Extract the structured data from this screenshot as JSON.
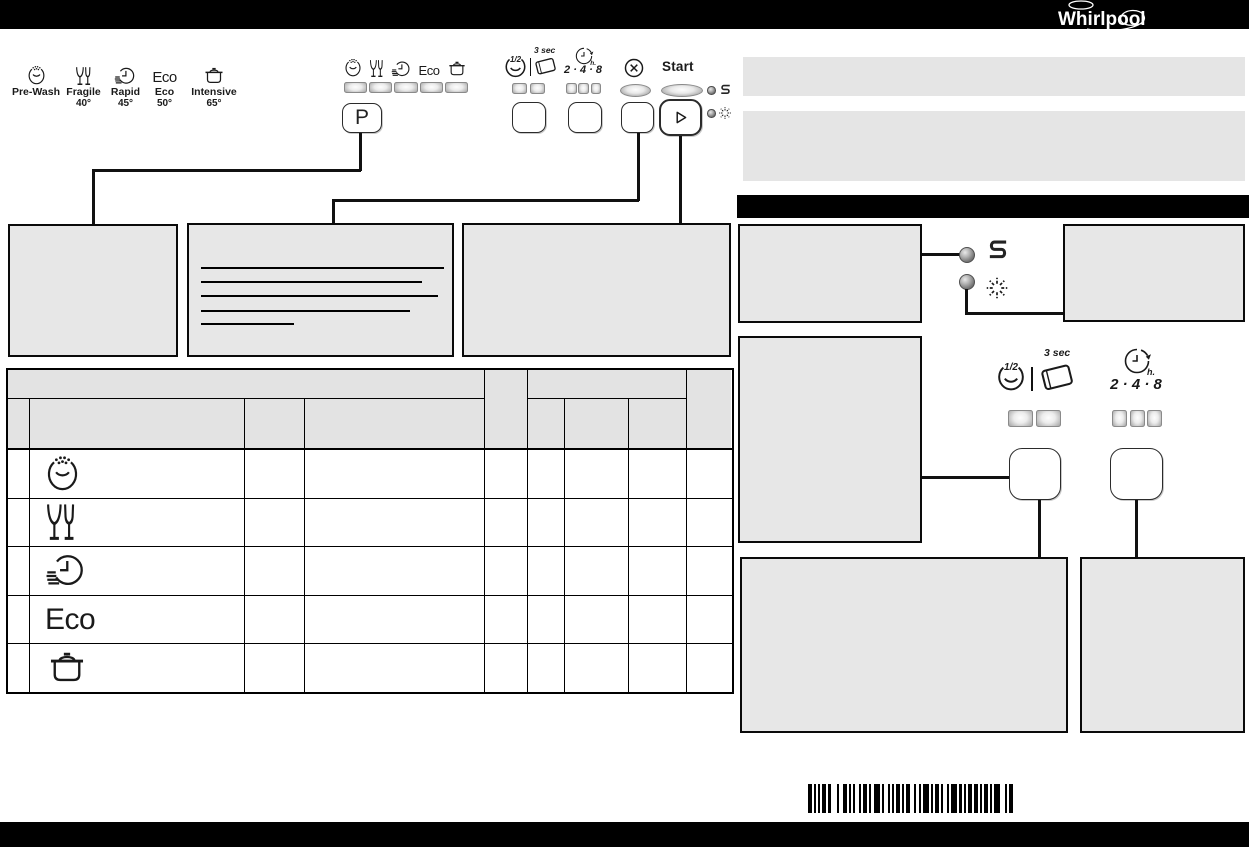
{
  "brand": {
    "logo_text": "Whirlpool"
  },
  "legend": {
    "programs": [
      {
        "name": "Pre-Wash",
        "temp": "",
        "icon": "prewash-icon"
      },
      {
        "name": "Fragile",
        "temp": "40°",
        "icon": "wine-glasses-icon"
      },
      {
        "name": "Rapid",
        "temp": "45°",
        "icon": "rapid-clock-icon"
      },
      {
        "name": "Eco",
        "temp": "50°",
        "icon": "eco-icon"
      },
      {
        "name": "Intensive",
        "temp": "65°",
        "icon": "pot-icon"
      }
    ]
  },
  "panel": {
    "program_button_label": "P",
    "eco_icon_text": "Eco",
    "half_load_label": "1/2",
    "tablet_hold_label": "3 sec",
    "delay_label": "2 · 4 · 8",
    "delay_unit_label": "h.",
    "start_label": "Start",
    "salt_indicator_label": "S"
  },
  "options": {
    "half_load_label": "1/2",
    "tablet_hold_label": "3 sec",
    "delay_label": "2 · 4 · 8",
    "delay_unit_label": "h.",
    "salt_indicator_label": "S"
  },
  "table": {
    "rows": [
      {
        "program_icon": "prewash-icon"
      },
      {
        "program_icon": "wine-glasses-icon"
      },
      {
        "program_icon": "rapid-clock-icon"
      },
      {
        "program_icon": "eco-icon"
      },
      {
        "program_icon": "pot-icon"
      }
    ]
  },
  "barcode": {
    "pattern": [
      2,
      1,
      1,
      1,
      1,
      1,
      2,
      1,
      1,
      3,
      1,
      2,
      2,
      1,
      1,
      1,
      1,
      2,
      1,
      1,
      2,
      1,
      1,
      1,
      3,
      1,
      1,
      2,
      1,
      1,
      1,
      1,
      2,
      1,
      1,
      1,
      2,
      2,
      1,
      1,
      1,
      1,
      3,
      1,
      1,
      1,
      2,
      1,
      1,
      2,
      1,
      1,
      3,
      1,
      1,
      1,
      1,
      1,
      2,
      1,
      2,
      1,
      1,
      1,
      2,
      1,
      1,
      1,
      3,
      2,
      1,
      1,
      2
    ]
  }
}
